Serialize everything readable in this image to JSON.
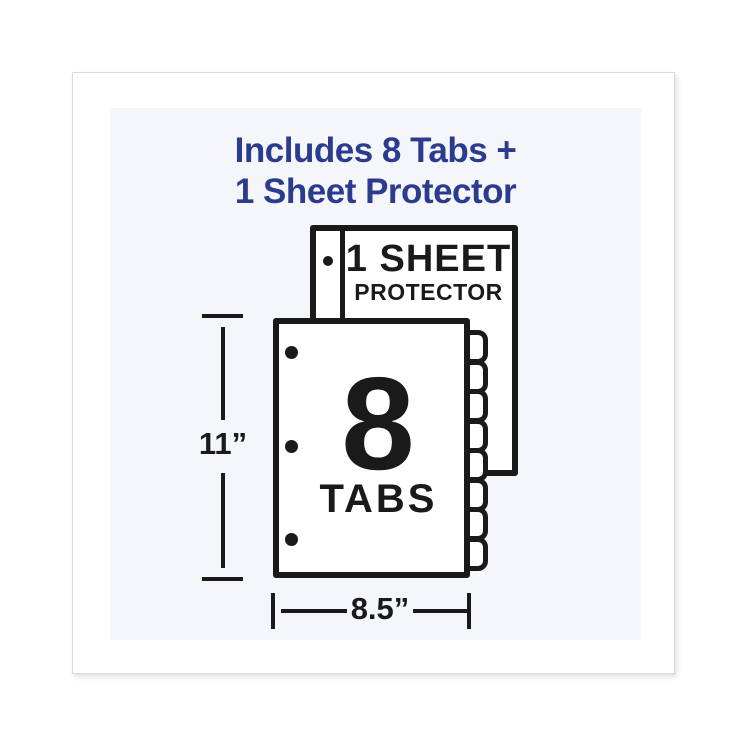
{
  "colors": {
    "accent_blue": "#2b3c8f",
    "ink": "#1a1a1a",
    "panel_bg": "#f5f6f9"
  },
  "headline": {
    "line1": "Includes 8 Tabs +",
    "line2": "1 Sheet Protector"
  },
  "sheet_protector": {
    "label_line1": "1 SHEET",
    "label_line2": "PROTECTOR",
    "hole_count": 1
  },
  "divider_sheet": {
    "big_number": "8",
    "label": "TABS",
    "hole_count": 3,
    "tab_count": 8
  },
  "dimensions": {
    "height_label": "11”",
    "width_label": "8.5”"
  }
}
